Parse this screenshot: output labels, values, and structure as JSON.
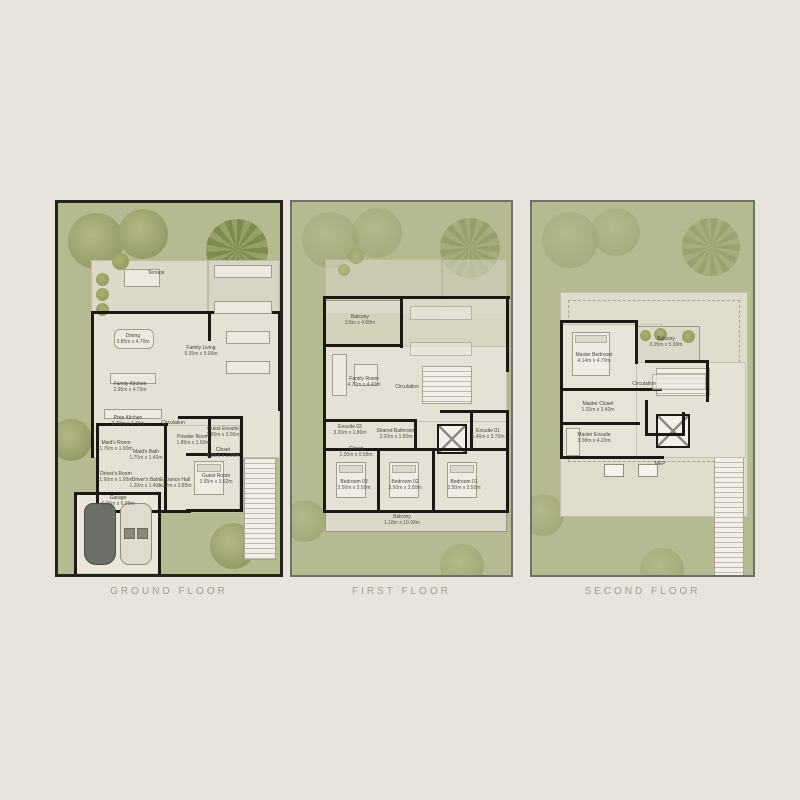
{
  "page": {
    "background": "#e9e4db",
    "grass_color": "#b5ba91",
    "wall_color": "#1c1915",
    "title_color": "#a29a8d"
  },
  "floors": [
    {
      "title": "GROUND FLOOR",
      "rooms": {
        "terrace": {
          "label": "Terrace",
          "dims": ""
        },
        "dining": {
          "label": "Dining",
          "dims": "3.85m x 4.70m"
        },
        "family_living": {
          "label": "Family Living",
          "dims": "5.35m x 5.00m"
        },
        "family_kitchen": {
          "label": "Family Kitchen",
          "dims": "2.95m x 4.70m"
        },
        "prep_kitchen": {
          "label": "Prep Kitchen",
          "dims": "2.70m x 4.70m"
        },
        "circulation": {
          "label": "Circulation",
          "dims": ""
        },
        "maids_room": {
          "label": "Maid's Room",
          "dims": "1.70m x 1.90m"
        },
        "maids_bath": {
          "label": "Maid's Bath",
          "dims": "1.70m x 1.40m"
        },
        "drivers_room": {
          "label": "Driver's Room",
          "dims": "1.60m x 1.95m"
        },
        "drivers_bath": {
          "label": "Driver's Bath",
          "dims": "1.20m x 1.40m"
        },
        "powder_room": {
          "label": "Powder Room",
          "dims": "1.85m x 1.50m"
        },
        "guest_ensuite": {
          "label": "Guest Ensuite",
          "dims": "1.95m x 3.00m"
        },
        "closet": {
          "label": "Closet",
          "dims": "0.60m x 1.95m"
        },
        "guest_room": {
          "label": "Guest Room",
          "dims": "3.95m x 3.62m"
        },
        "entrance_hall": {
          "label": "Entrance Hall",
          "dims": "1.22m x 3.85m"
        },
        "garage": {
          "label": "Garage",
          "dims": "6.00m x 6.00m"
        }
      }
    },
    {
      "title": "FIRST FLOOR",
      "rooms": {
        "balcony": {
          "label": "Balcony",
          "dims": "3.5m x 4.68m"
        },
        "family_room": {
          "label": "Family Room",
          "dims": "4.70m x 4.40m"
        },
        "circulation": {
          "label": "Circulation",
          "dims": ""
        },
        "ensuite_03": {
          "label": "Ensuite 03",
          "dims": "3.20m x 1.80m"
        },
        "shared_bathroom": {
          "label": "Shared Bathroom",
          "dims": "3.20m x 1.80m"
        },
        "ensuite_01": {
          "label": "Ensuite 01",
          "dims": "1.46m x 3.70m"
        },
        "closet": {
          "label": "Closet",
          "dims": "1.20m x 0.58m"
        },
        "bedroom_03": {
          "label": "Bedroom 03",
          "dims": "3.50m x 3.50m"
        },
        "bedroom_02": {
          "label": "Bedroom 02",
          "dims": "3.50m x 3.50m"
        },
        "bedroom_01": {
          "label": "Bedroom 01",
          "dims": "3.50m x 3.50m"
        },
        "balcony_rear": {
          "label": "Balcony",
          "dims": "1.18m x 10.98m"
        }
      }
    },
    {
      "title": "SECOND FLOOR",
      "rooms": {
        "master_bedroom": {
          "label": "Master Bedroom",
          "dims": "4.14m x 4.70m"
        },
        "balcony": {
          "label": "Balcony",
          "dims": "2.05m x 5.00m"
        },
        "circulation": {
          "label": "Circulation",
          "dims": ""
        },
        "master_closet": {
          "label": "Master Closet",
          "dims": "1.20m x 3.40m"
        },
        "master_ensuite": {
          "label": "Master Ensuite",
          "dims": "3.08m x 4.20m"
        },
        "mep": {
          "label": "MEP",
          "dims": ""
        }
      }
    }
  ]
}
